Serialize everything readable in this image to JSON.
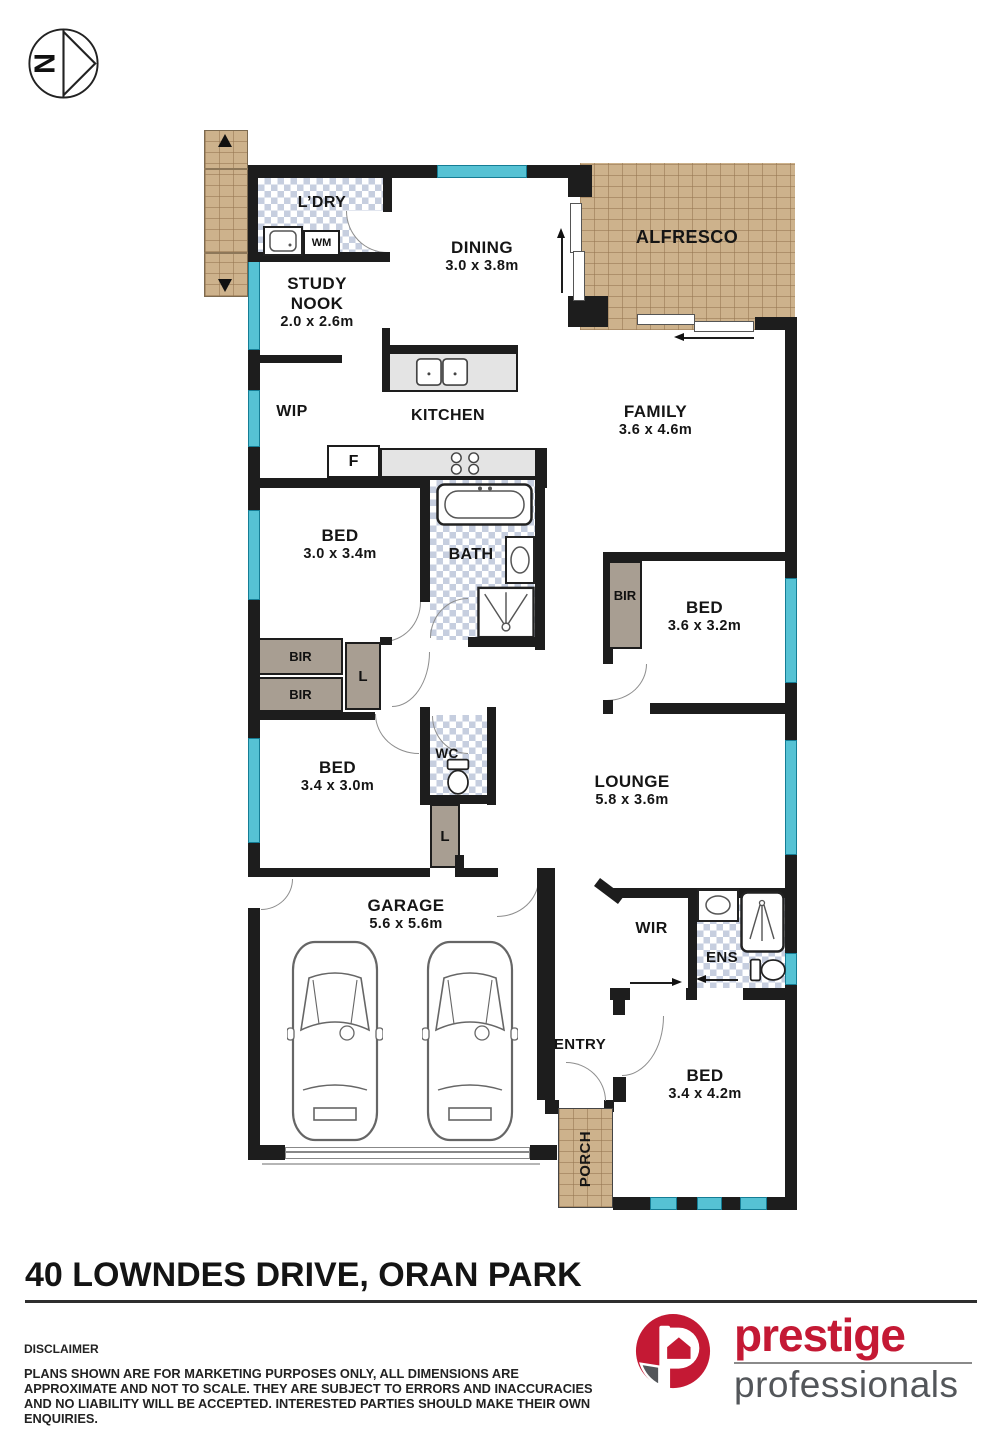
{
  "compass": {
    "label": "N"
  },
  "rooms": {
    "ldry": {
      "name": "L’DRY"
    },
    "dining": {
      "name": "DINING",
      "dims": "3.0 x 3.8m"
    },
    "alfresco": {
      "name": "ALFRESCO"
    },
    "study_nook": {
      "name": "STUDY NOOK",
      "dims": "2.0 x 2.6m"
    },
    "wip": {
      "name": "WIP"
    },
    "kitchen": {
      "name": "KITCHEN"
    },
    "family": {
      "name": "FAMILY",
      "dims": "3.6 x 4.6m"
    },
    "bed1": {
      "name": "BED",
      "dims": "3.0 x 3.4m"
    },
    "bath": {
      "name": "BATH"
    },
    "bed2": {
      "name": "BED",
      "dims": "3.6 x 3.2m"
    },
    "wc": {
      "name": "WC"
    },
    "bed3": {
      "name": "BED",
      "dims": "3.4 x 3.0m"
    },
    "lounge": {
      "name": "LOUNGE",
      "dims": "5.8 x 3.6m"
    },
    "garage": {
      "name": "GARAGE",
      "dims": "5.6 x 5.6m"
    },
    "wir": {
      "name": "WIR"
    },
    "ens": {
      "name": "ENS"
    },
    "entry": {
      "name": "ENTRY"
    },
    "bed4": {
      "name": "BED",
      "dims": "3.4 x 4.2m"
    },
    "porch": {
      "name": "PORCH"
    }
  },
  "closets": {
    "bir_right": "BIR",
    "bir_top": "BIR",
    "bir_bottom": "BIR",
    "linen1": "L",
    "linen2": "L"
  },
  "fixtures": {
    "washing_machine": "WM",
    "fridge": "F"
  },
  "footer": {
    "address": "40 LOWNDES DRIVE, ORAN PARK",
    "disclaimer_title": "DISCLAIMER",
    "disclaimer_body": "PLANS SHOWN ARE FOR MARKETING PURPOSES ONLY, ALL DIMENSIONS ARE APPROXIMATE AND NOT TO SCALE. THEY ARE SUBJECT TO ERRORS AND INACCURACIES AND NO LIABILITY WILL BE ACCEPTED. INTERESTED PARTIES SHOULD MAKE THEIR OWN ENQUIRIES."
  },
  "logo": {
    "line1": "prestige",
    "line2": "professionals"
  },
  "colors": {
    "wall": "#1d1d1d",
    "window": "#56c2d4",
    "brick": "#cdb28c",
    "tile": "#c6cedf",
    "closet": "#a89e92",
    "brand_red": "#c41934",
    "brand_gray": "#53565a"
  }
}
